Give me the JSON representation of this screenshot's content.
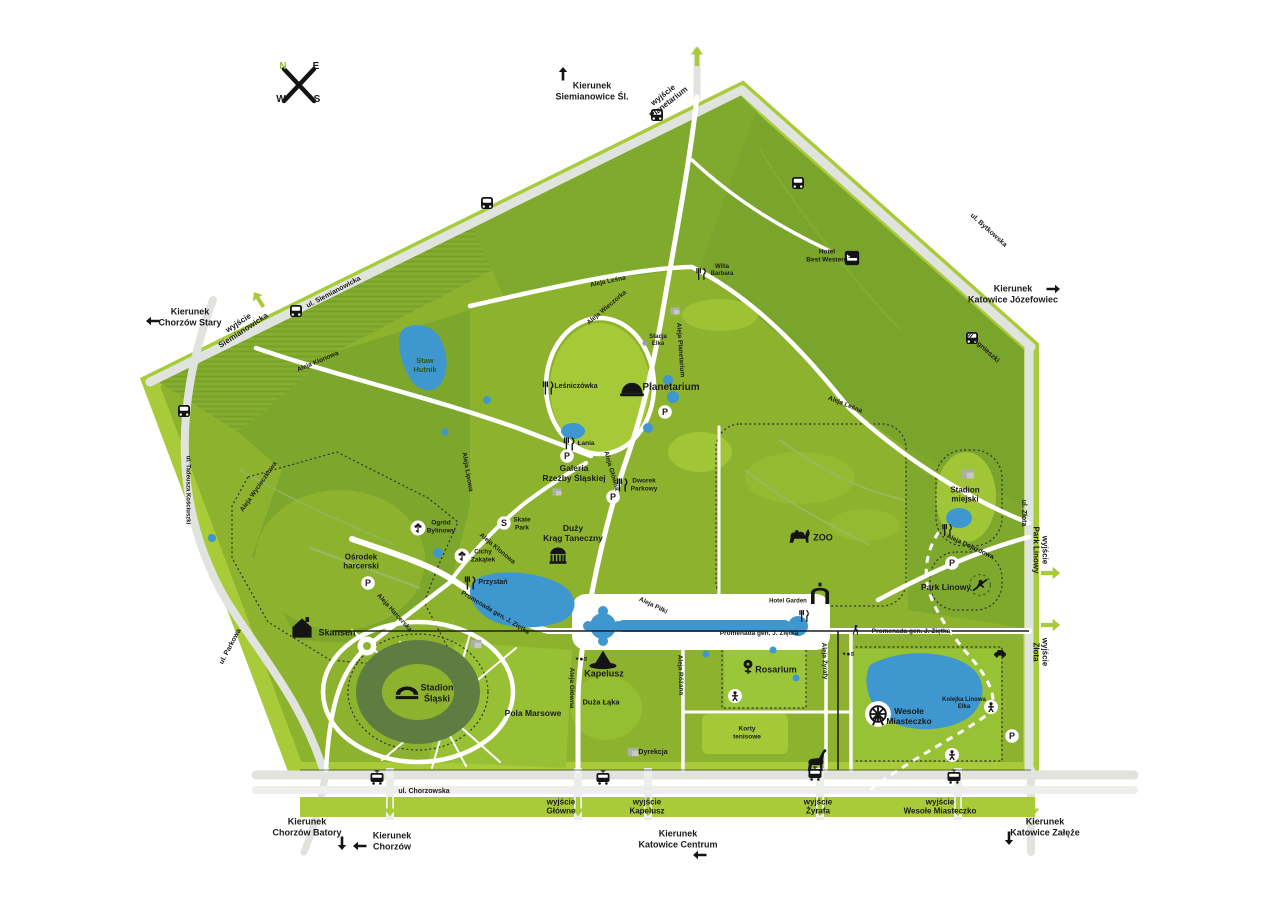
{
  "colors": {
    "park_green": "#8db32e",
    "forest_green": "#7aa52c",
    "light_green": "#a9cb3a",
    "road_gray": "#e1e3df",
    "water_blue": "#3e97cf",
    "stadium_ring": "#5f7d40",
    "text_dark": "#1b1b1b",
    "accent_green": "#8fbb2f"
  },
  "icon_glyphs": {
    "p": "P",
    "s": "S"
  },
  "labels": {
    "compass": [
      {
        "name": "compass-n",
        "text": "N",
        "x": 283,
        "y": 67,
        "size": 10,
        "color": "#8fbb2f"
      },
      {
        "name": "compass-e",
        "text": "E",
        "x": 316,
        "y": 67,
        "size": 10
      },
      {
        "name": "compass-w",
        "text": "W",
        "x": 281,
        "y": 100,
        "size": 10
      },
      {
        "name": "compass-s",
        "text": "S",
        "x": 317,
        "y": 100,
        "size": 10
      }
    ],
    "directions": [
      {
        "name": "direction-siemianowice",
        "text": "Kierunek\nSiemianowice Śl.",
        "x": 592,
        "y": 91,
        "size": 9
      },
      {
        "name": "direction-chorzow-stary",
        "text": "Kierunek\nChorzów Stary",
        "x": 190,
        "y": 317,
        "size": 9
      },
      {
        "name": "direction-katowice-jozefowiec",
        "text": "Kierunek\nKatowice Józefowiec",
        "x": 1013,
        "y": 294,
        "size": 9
      },
      {
        "name": "direction-chorzow-batory",
        "text": "Kierunek\nChorzów Batory",
        "x": 307,
        "y": 827,
        "size": 9
      },
      {
        "name": "direction-chorzow",
        "text": "Kierunek\nChorzów",
        "x": 392,
        "y": 841,
        "size": 9
      },
      {
        "name": "direction-katowice-centrum",
        "text": "Kierunek\nKatowice Centrum",
        "x": 678,
        "y": 839,
        "size": 9
      },
      {
        "name": "direction-katowice-zaleze",
        "text": "Kierunek\nKatowice Załęże",
        "x": 1045,
        "y": 827,
        "size": 9
      }
    ],
    "exits": [
      {
        "name": "exit-planetarium",
        "text": "wyjście\nPlanetarium",
        "x": 666,
        "y": 99,
        "rot": -38,
        "size": 8
      },
      {
        "name": "exit-siemianowicka",
        "text": "wyjście\nSiemianowicka",
        "x": 241,
        "y": 327,
        "rot": -33,
        "size": 8
      },
      {
        "name": "exit-park-linowy",
        "text": "wyjście\nPark Linowy",
        "x": 1040,
        "y": 550,
        "rot": 90,
        "size": 8
      },
      {
        "name": "exit-zlota",
        "text": "wyjście\nZłota",
        "x": 1040,
        "y": 652,
        "rot": 90,
        "size": 8
      },
      {
        "name": "exit-glowne",
        "text": "wyjście\nGłówne",
        "x": 561,
        "y": 807,
        "size": 8
      },
      {
        "name": "exit-kapelusz",
        "text": "wyjście\nKapelusz",
        "x": 647,
        "y": 807,
        "size": 8
      },
      {
        "name": "exit-zyrafa",
        "text": "wyjście\nŻyrafa",
        "x": 818,
        "y": 807,
        "size": 8
      },
      {
        "name": "exit-wesole-miasteczko",
        "text": "wyjście\nWesołe Miasteczko",
        "x": 940,
        "y": 807,
        "size": 8
      }
    ],
    "streets": [
      {
        "name": "street-siemianowicka",
        "text": "ul. Siemianowicka",
        "x": 334,
        "y": 293,
        "rot": -28,
        "size": 7
      },
      {
        "name": "street-bytkowska",
        "text": "ul. Bytkowska",
        "x": 988,
        "y": 231,
        "rot": 42,
        "size": 7
      },
      {
        "name": "street-agnieszki",
        "text": "ul. Agnieszki",
        "x": 982,
        "y": 348,
        "rot": 42,
        "size": 7
      },
      {
        "name": "street-zlota",
        "text": "ul. Złota",
        "x": 1023,
        "y": 513,
        "rot": 90,
        "size": 7
      },
      {
        "name": "street-chorzowska",
        "text": "ul. Chorzowska",
        "x": 424,
        "y": 792,
        "size": 7
      },
      {
        "name": "street-parkowa",
        "text": "ul. Parkowa",
        "x": 231,
        "y": 647,
        "rot": -62,
        "size": 7
      },
      {
        "name": "street-kosciuszki",
        "text": "ul. Tadeusza Kościuszki",
        "x": 187,
        "y": 490,
        "rot": 90,
        "size": 6
      }
    ],
    "alleys": [
      {
        "name": "aleja-klonowa-1",
        "text": "Aleja Klonowa",
        "x": 318,
        "y": 362,
        "rot": -23,
        "size": 6.5
      },
      {
        "name": "aleja-klonowa-2",
        "text": "Aleja Klonowa",
        "x": 497,
        "y": 549,
        "rot": 40,
        "size": 6.5
      },
      {
        "name": "aleja-wycieczkowa",
        "text": "Aleja Wycieczkowa",
        "x": 259,
        "y": 487,
        "rot": -55,
        "size": 6.5
      },
      {
        "name": "aleja-lesna-1",
        "text": "Aleja Leśna",
        "x": 608,
        "y": 282,
        "rot": -12,
        "size": 6.5
      },
      {
        "name": "aleja-wieczorka",
        "text": "Aleja Wieczorka",
        "x": 607,
        "y": 308,
        "rot": -40,
        "size": 6.5
      },
      {
        "name": "aleja-planetarium",
        "text": "Aleja Planetarium",
        "x": 680,
        "y": 350,
        "rot": 86,
        "size": 6.5
      },
      {
        "name": "aleja-lesna-2",
        "text": "Aleja Leśna",
        "x": 845,
        "y": 405,
        "rot": 22,
        "size": 6.5
      },
      {
        "name": "aleja-glowna-1",
        "text": "Aleja Główna",
        "x": 611,
        "y": 471,
        "rot": 74,
        "size": 6.5
      },
      {
        "name": "aleja-glowna-2",
        "text": "Aleja Główna",
        "x": 571,
        "y": 688,
        "rot": 90,
        "size": 6.5
      },
      {
        "name": "aleja-lipowa",
        "text": "Aleja Lipowa",
        "x": 467,
        "y": 472,
        "rot": 80,
        "size": 6.5
      },
      {
        "name": "aleja-harcerska",
        "text": "Aleja Harcerska",
        "x": 394,
        "y": 613,
        "rot": 48,
        "size": 6.5
      },
      {
        "name": "promenada-zietka-1",
        "text": "Promenada gen. J. Ziętka",
        "x": 495,
        "y": 613,
        "rot": 31,
        "size": 6.5
      },
      {
        "name": "promenada-zietka-2",
        "text": "Promenada gen. J. Ziętka",
        "x": 759,
        "y": 634,
        "size": 6.5
      },
      {
        "name": "promenada-zietka-3",
        "text": "Promenada gen. J. Ziętka",
        "x": 911,
        "y": 632,
        "size": 6.5
      },
      {
        "name": "aleja-pilki",
        "text": "Aleja Piłki",
        "x": 653,
        "y": 606,
        "rot": 26,
        "size": 6.5
      },
      {
        "name": "aleja-rozana",
        "text": "Aleja Różana",
        "x": 680,
        "y": 675,
        "rot": 88,
        "size": 6.5
      },
      {
        "name": "aleja-zyrafy",
        "text": "Aleja Żyrafy",
        "x": 824,
        "y": 661,
        "rot": 88,
        "size": 6.5
      },
      {
        "name": "aleja-dojazdowa",
        "text": "Aleja Dojazdowa",
        "x": 970,
        "y": 547,
        "rot": 25,
        "size": 6.5
      }
    ],
    "pois": [
      {
        "name": "poi-staw-hutnik",
        "text": "Staw\nHutnik",
        "x": 425,
        "y": 366,
        "size": 7.5,
        "color": "#2d5a1a"
      },
      {
        "name": "poi-planetarium",
        "text": "Planetarium",
        "x": 671,
        "y": 388,
        "size": 10
      },
      {
        "name": "poi-lesniczowka",
        "text": "Leśniczówka",
        "x": 576,
        "y": 387,
        "size": 7
      },
      {
        "name": "poi-lania",
        "text": "Łania",
        "x": 586,
        "y": 444,
        "size": 6.5
      },
      {
        "name": "poi-galeria-rzezby",
        "text": "Galeria\nRzeźby Śląskiej",
        "x": 574,
        "y": 473,
        "size": 8.5
      },
      {
        "name": "poi-dworek-parkowy",
        "text": "Dworek\nParkowy",
        "x": 644,
        "y": 485,
        "size": 6.5
      },
      {
        "name": "poi-skate-park",
        "text": "Skate\nPark",
        "x": 522,
        "y": 524,
        "size": 6.5
      },
      {
        "name": "poi-duzy-krag",
        "text": "Duży\nKrąg Taneczny",
        "x": 573,
        "y": 533,
        "size": 8.5
      },
      {
        "name": "poi-ogrod-bylinowy",
        "text": "Ogród\nBylinowy",
        "x": 441,
        "y": 527,
        "size": 6.5
      },
      {
        "name": "poi-cichy-zakatek",
        "text": "Cichy\nZakątek",
        "x": 483,
        "y": 556,
        "size": 6.5
      },
      {
        "name": "poi-przystan",
        "text": "Przystań",
        "x": 493,
        "y": 583,
        "size": 7
      },
      {
        "name": "poi-osrodek-harcerski",
        "text": "Ośrodek\nharcerski",
        "x": 361,
        "y": 562,
        "size": 8
      },
      {
        "name": "poi-skansen",
        "text": "Skansen",
        "x": 337,
        "y": 633,
        "size": 9
      },
      {
        "name": "poi-stadion-slaski",
        "text": "Stadion\nŚląski",
        "x": 437,
        "y": 693,
        "size": 9
      },
      {
        "name": "poi-pola-marsowe",
        "text": "Pola Marsowe",
        "x": 533,
        "y": 713,
        "size": 8.5
      },
      {
        "name": "poi-kapelusz",
        "text": "Kapelusz",
        "x": 604,
        "y": 674,
        "size": 9
      },
      {
        "name": "poi-duza-laka",
        "text": "Duża Łąka",
        "x": 601,
        "y": 703,
        "size": 7.5
      },
      {
        "name": "poi-dyrekcja",
        "text": "Dyrekcja",
        "x": 653,
        "y": 753,
        "size": 7
      },
      {
        "name": "poi-rosarium",
        "text": "Rosarium",
        "x": 776,
        "y": 670,
        "size": 9
      },
      {
        "name": "poi-korty-tenisowe",
        "text": "Korty\ntenisowe",
        "x": 747,
        "y": 733,
        "size": 6.5
      },
      {
        "name": "poi-zoo",
        "text": "ZOO",
        "x": 823,
        "y": 538,
        "size": 9
      },
      {
        "name": "poi-hotel-garden",
        "text": "Hotel Garden",
        "x": 788,
        "y": 602,
        "size": 6
      },
      {
        "name": "poi-hotel-best-western",
        "text": "Hotel\nBest Western",
        "x": 827,
        "y": 256,
        "size": 6.5
      },
      {
        "name": "poi-willa-barbara",
        "text": "Willa\nBarbara",
        "x": 722,
        "y": 271,
        "size": 6
      },
      {
        "name": "poi-stacja-elka",
        "text": "Stacja\nElka",
        "x": 658,
        "y": 341,
        "size": 6
      },
      {
        "name": "poi-stadion-miejski",
        "text": "Stadion\nmiejski",
        "x": 965,
        "y": 495,
        "size": 8
      },
      {
        "name": "poi-park-linowy",
        "text": "Park Linowy",
        "x": 946,
        "y": 587,
        "size": 8.5
      },
      {
        "name": "poi-wesole-miasteczko",
        "text": "Wesołe\nMiasteczko",
        "x": 909,
        "y": 716,
        "size": 8.5
      },
      {
        "name": "poi-kolejka-elka",
        "text": "Kolejka Linowa\nElka",
        "x": 964,
        "y": 704,
        "size": 6
      }
    ]
  },
  "icons": [
    {
      "name": "arrow-up-siemianowice-icon",
      "type": "arrow-b",
      "x": 563,
      "y": 74
    },
    {
      "name": "arrow-left-chorzow-stary-icon",
      "type": "arrow-b",
      "x": 153,
      "y": 321,
      "rot": -90
    },
    {
      "name": "arrow-right-jozefowiec-icon",
      "type": "arrow-b",
      "x": 1053,
      "y": 289,
      "rot": 90
    },
    {
      "name": "arrow-down-batory-icon",
      "type": "arrow-b",
      "x": 342,
      "y": 843,
      "rot": 180
    },
    {
      "name": "arrow-left-chorzow-icon",
      "type": "arrow-b",
      "x": 360,
      "y": 846,
      "rot": -90
    },
    {
      "name": "arrow-left-katowice-centrum-icon",
      "type": "arrow-b",
      "x": 700,
      "y": 855,
      "rot": -90
    },
    {
      "name": "arrow-down-zaleze-icon",
      "type": "arrow-b",
      "x": 1009,
      "y": 838,
      "rot": 180
    },
    {
      "name": "exit-arrow-top-icon",
      "type": "arrow-g",
      "x": 697,
      "y": 57,
      "s": 1.2
    },
    {
      "name": "exit-arrow-siemianowicka-icon",
      "type": "arrow-g",
      "x": 259,
      "y": 300,
      "rot": -33,
      "s": 1.1
    },
    {
      "name": "exit-arrow-park-linowy-icon",
      "type": "arrow-g",
      "x": 1050,
      "y": 573,
      "rot": 90,
      "s": 1.2
    },
    {
      "name": "exit-arrow-zlota-icon",
      "type": "arrow-g",
      "x": 1050,
      "y": 625,
      "rot": 90,
      "s": 1.2
    },
    {
      "name": "exit-arrow-1-icon",
      "type": "arrow-g",
      "x": 390,
      "y": 806,
      "rot": 180,
      "s": 1.2
    },
    {
      "name": "exit-arrow-glowne-icon",
      "type": "arrow-g",
      "x": 578,
      "y": 806,
      "rot": 180,
      "s": 1.2
    },
    {
      "name": "exit-arrow-kapelusz-icon",
      "type": "arrow-g",
      "x": 648,
      "y": 806,
      "rot": 180,
      "s": 1.2
    },
    {
      "name": "exit-arrow-zyrafa-icon",
      "type": "arrow-g",
      "x": 820,
      "y": 806,
      "rot": 180,
      "s": 1.2
    },
    {
      "name": "exit-arrow-wesole-icon",
      "type": "arrow-g",
      "x": 958,
      "y": 806,
      "rot": 180,
      "s": 1.2
    },
    {
      "name": "exit-arrow-zaleze-icon",
      "type": "arrow-g",
      "x": 1033,
      "y": 806,
      "rot": 180,
      "s": 1.2
    },
    {
      "name": "bus-stop-1-icon",
      "type": "bus",
      "x": 657,
      "y": 115
    },
    {
      "name": "bus-stop-2-icon",
      "type": "bus",
      "x": 296,
      "y": 311
    },
    {
      "name": "bus-stop-3-icon",
      "type": "bus",
      "x": 184,
      "y": 411
    },
    {
      "name": "bus-stop-4-icon",
      "type": "bus",
      "x": 487,
      "y": 203
    },
    {
      "name": "bus-stop-5-icon",
      "type": "bus",
      "x": 798,
      "y": 183
    },
    {
      "name": "bus-stop-6-icon",
      "type": "bus",
      "x": 972,
      "y": 338
    },
    {
      "name": "tram-stop-1-icon",
      "type": "tram",
      "x": 377,
      "y": 778
    },
    {
      "name": "tram-stop-2-icon",
      "type": "tram",
      "x": 603,
      "y": 778
    },
    {
      "name": "tram-stop-3-icon",
      "type": "tram",
      "x": 815,
      "y": 774
    },
    {
      "name": "tram-stop-4-icon",
      "type": "tram",
      "x": 954,
      "y": 777
    },
    {
      "name": "tramstop-kapelusz-icon",
      "type": "tramstop",
      "x": 581,
      "y": 660
    },
    {
      "name": "tramstop-zyrafa-icon",
      "type": "tramstop",
      "x": 848,
      "y": 655
    },
    {
      "name": "restaurant-lesniczowka-icon",
      "type": "fork",
      "x": 548,
      "y": 388
    },
    {
      "name": "restaurant-lania-icon",
      "type": "fork",
      "x": 569,
      "y": 444
    },
    {
      "name": "restaurant-dworek-icon",
      "type": "fork",
      "x": 622,
      "y": 485
    },
    {
      "name": "restaurant-przystan-icon",
      "type": "fork",
      "x": 470,
      "y": 583
    },
    {
      "name": "restaurant-willa-icon",
      "type": "fork",
      "x": 701,
      "y": 274,
      "s": 0.9
    },
    {
      "name": "restaurant-stadion-miejski-icon",
      "type": "fork",
      "x": 947,
      "y": 530,
      "s": 0.9
    },
    {
      "name": "restaurant-hotel-garden-icon",
      "type": "fork",
      "x": 804,
      "y": 616,
      "s": 0.9
    },
    {
      "name": "parking-planetarium-icon",
      "type": "p",
      "x": 665,
      "y": 412
    },
    {
      "name": "parking-lania-icon",
      "type": "p",
      "x": 567,
      "y": 456
    },
    {
      "name": "parking-dworek-icon",
      "type": "p",
      "x": 613,
      "y": 497
    },
    {
      "name": "parking-harcerski-icon",
      "type": "p",
      "x": 368,
      "y": 583
    },
    {
      "name": "parking-stadion-miejski-icon",
      "type": "p",
      "x": 952,
      "y": 563
    },
    {
      "name": "parking-wesole-icon",
      "type": "p",
      "x": 1012,
      "y": 736
    },
    {
      "name": "skatepark-icon",
      "type": "s",
      "x": 504,
      "y": 523
    },
    {
      "name": "planetarium-dome-icon",
      "type": "dome",
      "x": 632,
      "y": 388,
      "s": 1.5
    },
    {
      "name": "rotunda-icon",
      "type": "rotunda",
      "x": 558,
      "y": 556,
      "s": 1.3
    },
    {
      "name": "garden-bylinowy-icon",
      "type": "flower",
      "x": 418,
      "y": 528,
      "s": 1.1
    },
    {
      "name": "garden-zakatek-icon",
      "type": "flower",
      "x": 462,
      "y": 556,
      "s": 1.1
    },
    {
      "name": "skansen-house-icon",
      "type": "house",
      "x": 302,
      "y": 628,
      "s": 1.6
    },
    {
      "name": "stadium-icon",
      "type": "stadium",
      "x": 407,
      "y": 691,
      "s": 1.5
    },
    {
      "name": "kapelusz-hat-icon",
      "type": "hat",
      "x": 603,
      "y": 660,
      "s": 1.7
    },
    {
      "name": "dyrekcja-building-icon",
      "type": "bldg-gray",
      "x": 633,
      "y": 752,
      "s": 1.2
    },
    {
      "name": "elka-station-building-icon",
      "type": "bldg-gray",
      "x": 476,
      "y": 644,
      "s": 1.2
    },
    {
      "name": "stands-building-icon",
      "type": "bldg-gray",
      "x": 968,
      "y": 474,
      "s": 1.3
    },
    {
      "name": "galeria-building-icon",
      "type": "bldg-gray",
      "x": 557,
      "y": 492
    },
    {
      "name": "road-building-icon",
      "type": "bldg-gray",
      "x": 675,
      "y": 311
    },
    {
      "name": "rose-icon",
      "type": "rose",
      "x": 748,
      "y": 666,
      "s": 1.3
    },
    {
      "name": "camel-zoo-icon",
      "type": "camel",
      "x": 800,
      "y": 536,
      "s": 1.5
    },
    {
      "name": "zoo-gate-icon",
      "type": "gate",
      "x": 820,
      "y": 595,
      "s": 1.5
    },
    {
      "name": "hotel-bed-icon",
      "type": "bed",
      "x": 852,
      "y": 258,
      "s": 1.1
    },
    {
      "name": "ferris-wheel-icon",
      "type": "ferris",
      "x": 878,
      "y": 714,
      "s": 1.7
    },
    {
      "name": "climber-icon",
      "type": "climber",
      "x": 980,
      "y": 585,
      "s": 1.3
    },
    {
      "name": "playground-rosarium-icon",
      "type": "person",
      "x": 735,
      "y": 696
    },
    {
      "name": "playground-wesole-icon",
      "type": "person",
      "x": 952,
      "y": 755
    },
    {
      "name": "elka-rider-icon",
      "type": "person",
      "x": 991,
      "y": 707
    },
    {
      "name": "walker-promenade-icon",
      "type": "walk",
      "x": 856,
      "y": 630,
      "s": 0.9
    },
    {
      "name": "giraffe-icon",
      "type": "giraffe",
      "x": 816,
      "y": 762,
      "s": 1.5
    },
    {
      "name": "car-icon",
      "type": "car",
      "x": 1000,
      "y": 653
    },
    {
      "name": "elka-station-dot-icon",
      "type": "dot-gray",
      "x": 645,
      "y": 343
    }
  ]
}
